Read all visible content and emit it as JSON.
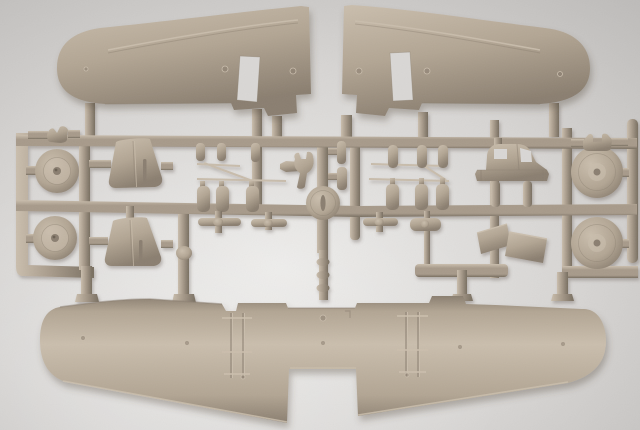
{
  "image": {
    "type": "photograph",
    "subject": "Injection-molded plastic model aircraft sprue in tan styrene on a light gray surface",
    "background": "plain light-gray studio surface with soft vignette"
  },
  "colors": {
    "bg_light": "#ecebe9",
    "bg_mid": "#d7d5d3",
    "bg_dark": "#bcbab8",
    "plastic": "#b2a593",
    "plastic_light": "#cabead",
    "plastic_dark": "#8a7e6f",
    "runner": "#a79a8a",
    "runner_dark": "#786e60",
    "hole": "#d9d7d5"
  },
  "parts": {
    "upper_wing_left": "left upper wing panel with rectangular opening and rivet pins",
    "upper_wing_right": "right upper wing panel with rectangular opening and rivet pins",
    "lower_wing": "one-piece full-span lower wing with ladder-style rib details",
    "wheels": "four round main wheels with hubs",
    "tailplanes": "two trapezoidal stabilizer halves",
    "cabin_section": "cockpit / cabin fuselage section with window openings",
    "hatch_plates": "two flat angled hatch plates",
    "brackets": "two small saddle brackets",
    "fork_part": "small fork / clevis piece",
    "cowl_disc": "round cowl disc with slot",
    "small_parts": "cylinders, bottle-shaped parts, tee struts and thin rods on the runner frame"
  }
}
